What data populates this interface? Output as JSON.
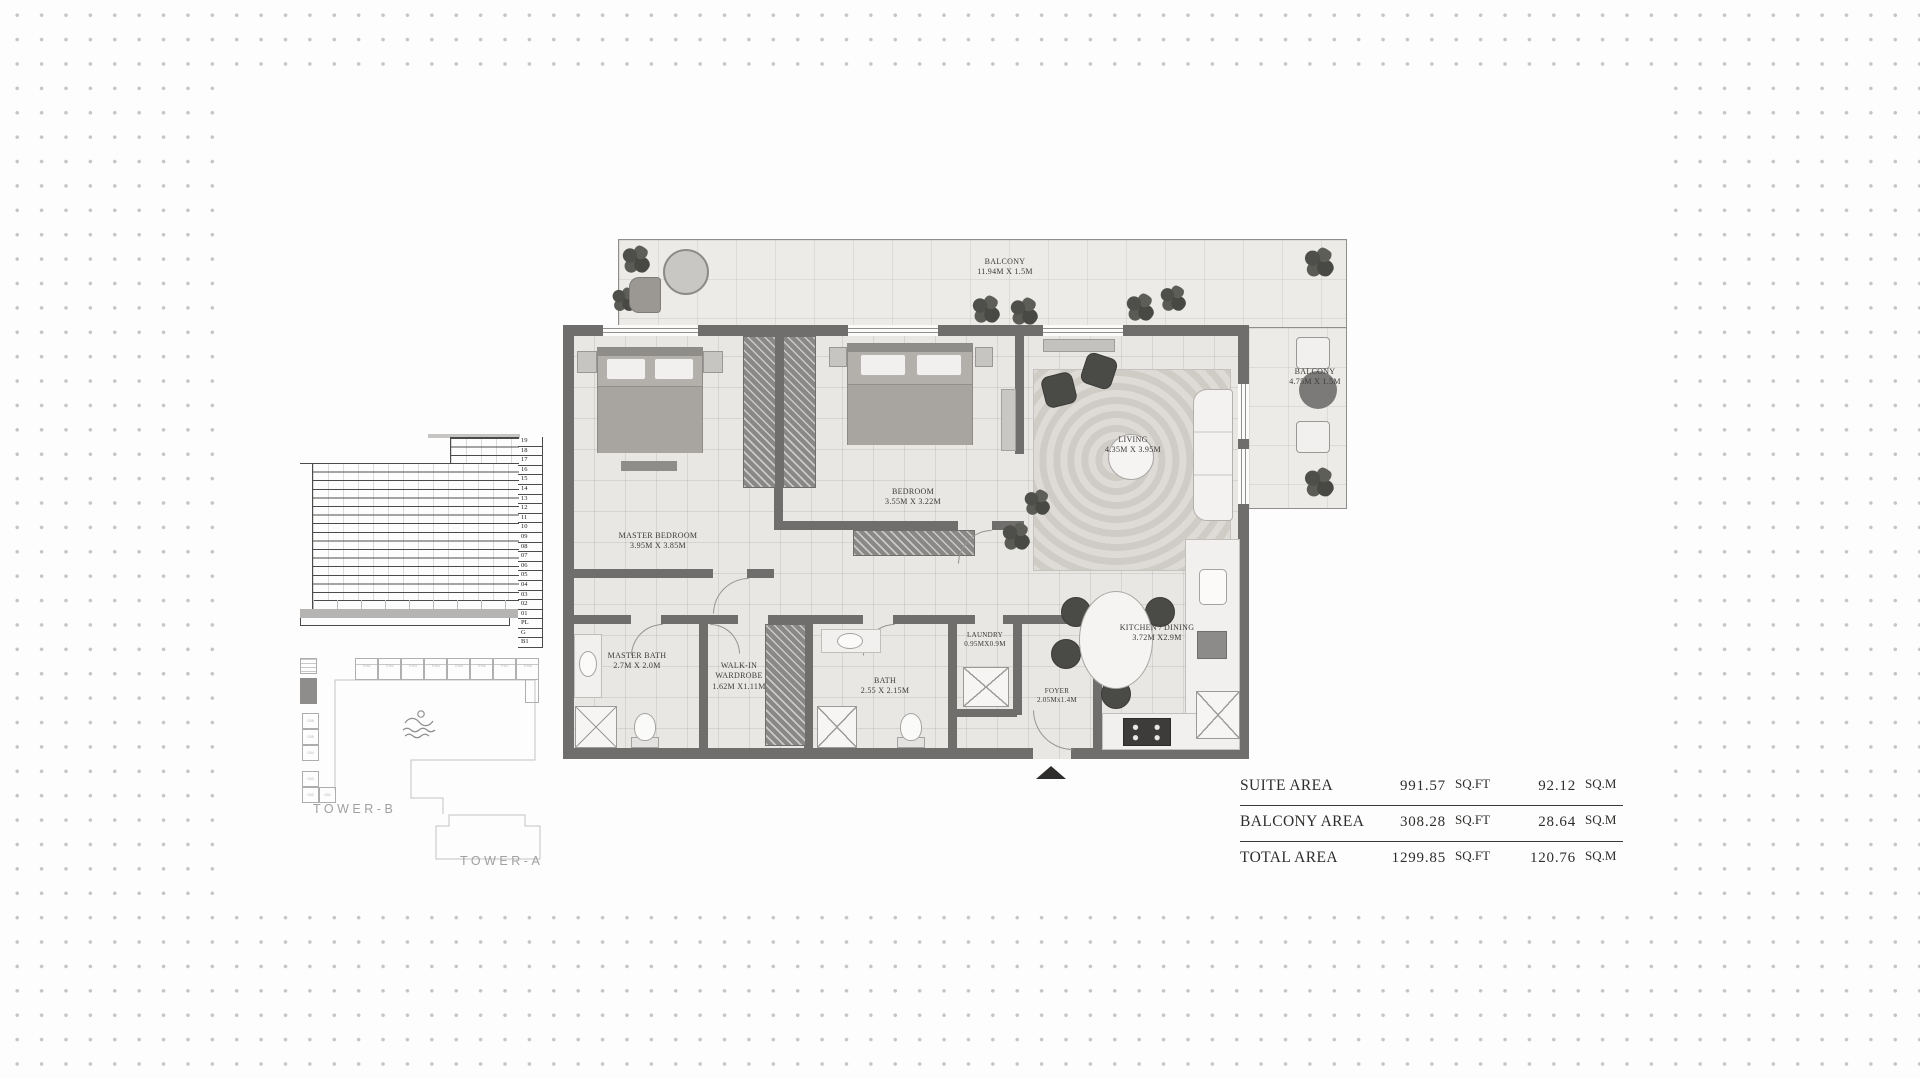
{
  "plan": {
    "rooms": {
      "balcony_top": {
        "name": "BALCONY",
        "dims": "11.94M X 1.5M"
      },
      "balcony_right": {
        "name": "BALCONY",
        "dims": "4.75M X 1.5M"
      },
      "living": {
        "name": "LIVING",
        "dims": "4.35M X 3.95M"
      },
      "master_bedroom": {
        "name": "MASTER BEDROOM",
        "dims": "3.95M X 3.85M"
      },
      "bedroom": {
        "name": "BEDROOM",
        "dims": "3.55M X 3.22M"
      },
      "master_bath": {
        "name": "MASTER BATH",
        "dims": "2.7M X 2.0M"
      },
      "walk_in_wardrobe": {
        "name": "WALK-IN WARDROBE",
        "dims": "1.62M X1.11M"
      },
      "bath": {
        "name": "BATH",
        "dims": "2.55 X 2.15M"
      },
      "laundry": {
        "name": "LAUNDRY",
        "dims": "0.95MX0.9M"
      },
      "kitchen_dining": {
        "name": "KITCHEN / DINING",
        "dims": "3.72M X2.9M"
      },
      "foyer": {
        "name": "FOYER",
        "dims": "2.05Mx1.4M"
      }
    }
  },
  "elevation": {
    "floors": [
      "19",
      "18",
      "17",
      "16",
      "15",
      "14",
      "13",
      "12",
      "11",
      "10",
      "09",
      "08",
      "07",
      "06",
      "05",
      "04",
      "03",
      "02",
      "01",
      "PL",
      "G",
      "B1"
    ]
  },
  "site": {
    "townhouses": [
      "TH01",
      "TH02",
      "TH03",
      "TH04",
      "TH05",
      "TH06",
      "TH07",
      "TH08"
    ],
    "ground_units": [
      "G06",
      "G05",
      "G04",
      "G03",
      "G02",
      "G01"
    ],
    "tower_b": "TOWER-B",
    "tower_a": "TOWER-A"
  },
  "area_table": {
    "rows": [
      {
        "label": "SUITE AREA",
        "sqft": "991.57",
        "sqft_unit": "SQ.FT",
        "sqm": "92.12",
        "sqm_unit": "SQ.M"
      },
      {
        "label": "BALCONY AREA",
        "sqft": "308.28",
        "sqft_unit": "SQ.FT",
        "sqm": "28.64",
        "sqm_unit": "SQ.M"
      },
      {
        "label": "TOTAL AREA",
        "sqft": "1299.85",
        "sqft_unit": "SQ.FT",
        "sqm": "120.76",
        "sqm_unit": "SQ.M"
      }
    ]
  },
  "colors": {
    "wall": "#6f6e6c",
    "floor": "#e9e7e4",
    "label_text": "#3b3a38",
    "dot": "#c5c5c5"
  }
}
